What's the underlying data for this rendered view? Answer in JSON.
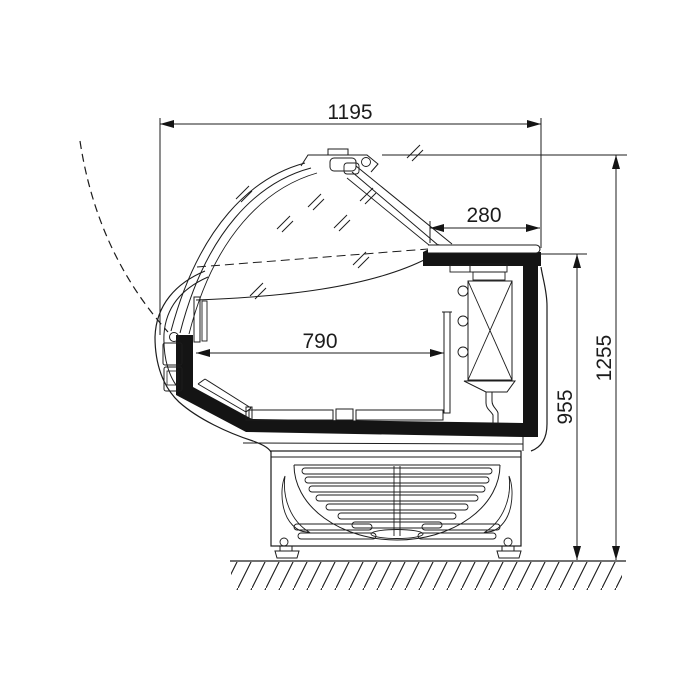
{
  "dimensions": {
    "overall_width": "1195",
    "rear_shelf_depth": "280",
    "display_well_width": "790",
    "worktop_height": "955",
    "overall_height": "1255"
  }
}
